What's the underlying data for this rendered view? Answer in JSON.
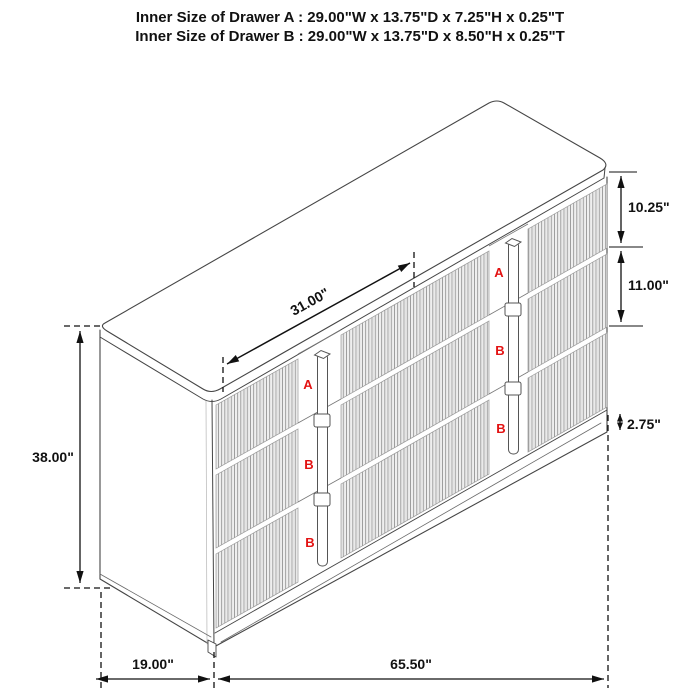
{
  "title": {
    "line1": "Inner Size of Drawer A : 29.00\"W x 13.75\"D x 7.25\"H x 0.25\"T",
    "line2": "Inner Size of Drawer B : 29.00\"W x 13.75\"D x 8.50\"H x 0.25\"T"
  },
  "dimensions": {
    "overall_height": "38.00\"",
    "overall_depth": "19.00\"",
    "overall_width": "65.50\"",
    "top_section_width": "31.00\"",
    "drawer_a_front_height": "10.25\"",
    "drawer_b_front_height": "11.00\"",
    "base_height": "2.75\""
  },
  "drawer_labels": {
    "left_column": [
      "A",
      "B",
      "B"
    ],
    "right_column": [
      "A",
      "B",
      "B"
    ]
  },
  "colors": {
    "drawing_line": "#454545",
    "dimension_line": "#111111",
    "drawer_label": "#e31212",
    "background": "#ffffff"
  }
}
